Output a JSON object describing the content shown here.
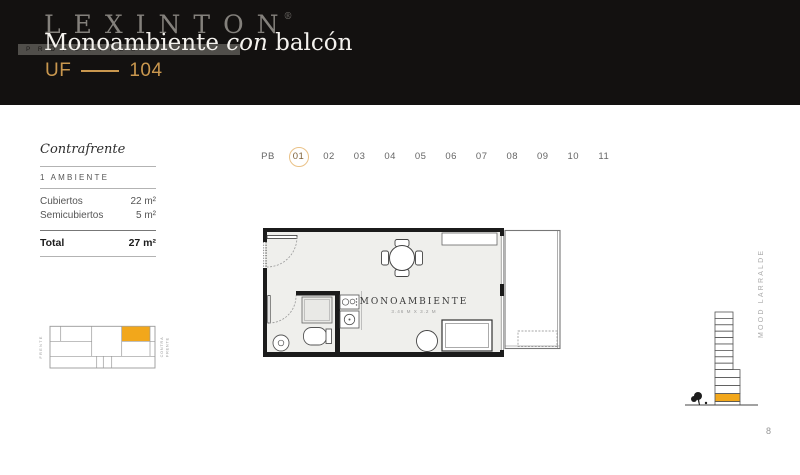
{
  "header": {
    "logo": "LEXINTON",
    "registered_mark": "®",
    "logo_subtext": "PROPERTIES",
    "title": {
      "word1": "Monoambiente",
      "word2_italic": "con",
      "word3": "balcón"
    },
    "unit": {
      "prefix": "UF",
      "number": "104"
    }
  },
  "info_panel": {
    "orientation": "Contrafrente",
    "ambientes": "1 AMBIENTE",
    "rows": [
      {
        "label": "Cubiertos",
        "value": "22 m²"
      },
      {
        "label": "Semicubiertos",
        "value": "5 m²"
      }
    ],
    "total": {
      "label": "Total",
      "value": "27 m²"
    }
  },
  "floor_selector": {
    "levels": [
      "PB",
      "01",
      "02",
      "03",
      "04",
      "05",
      "06",
      "07",
      "08",
      "09",
      "10",
      "11"
    ],
    "selected_level": "01"
  },
  "floor_plan": {
    "room_label": "MONOAMBIENTE",
    "room_dimensions": "3.46 M X 3.2 M"
  },
  "mini_plan": {
    "front_label": "FRENTE",
    "back_label_line1": "CONTRA",
    "back_label_line2": "FRENTE"
  },
  "side_label": "MOOD LARRALDE",
  "page_number": "8",
  "colors": {
    "accent_orange": "#F2A71B",
    "gold": "#C9974E",
    "header_background": "#131110"
  }
}
